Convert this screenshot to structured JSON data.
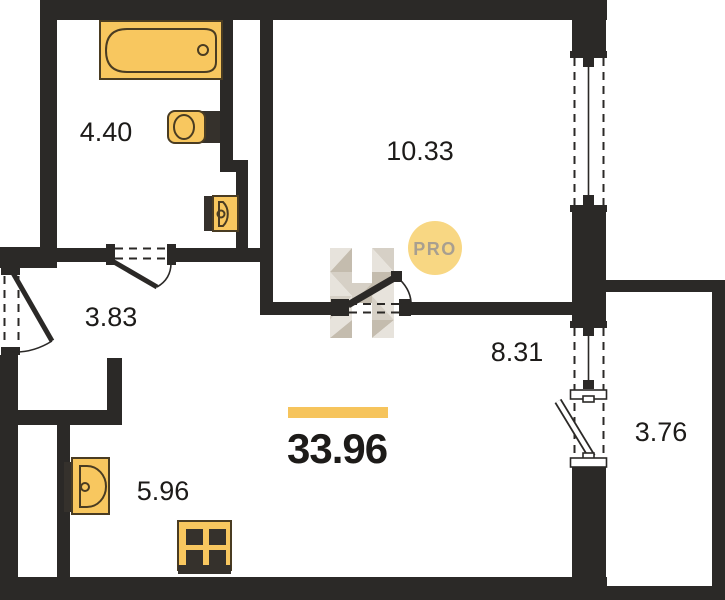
{
  "plan": {
    "title": "apartment-floor-plan",
    "areas": {
      "bathroom": "4.40",
      "bedroom": "10.33",
      "hallway": "3.83",
      "living": "8.31",
      "balcony": "3.76",
      "kitchen": "5.96",
      "total": "33.96"
    },
    "watermark": {
      "badge_text": "PRO",
      "logo_letter": "H"
    },
    "fixtures": [
      "bathtub",
      "toilet",
      "washbasin",
      "kitchen-sink",
      "stove"
    ],
    "colors": {
      "background": "#ffffff",
      "wall": "#2b2927",
      "fixture_fill": "#f8c75f",
      "fixture_stroke": "#4a3c22",
      "fixture_dark": "#35312c",
      "accent_bar": "#f6c45c",
      "badge_fill": "#f8d783",
      "badge_text": "#a89f90",
      "watermark_light": "#e7e3dc",
      "watermark_mid": "#d6d0c6",
      "watermark_dark": "#c4bcae",
      "label_text": "#1d1b19"
    }
  }
}
